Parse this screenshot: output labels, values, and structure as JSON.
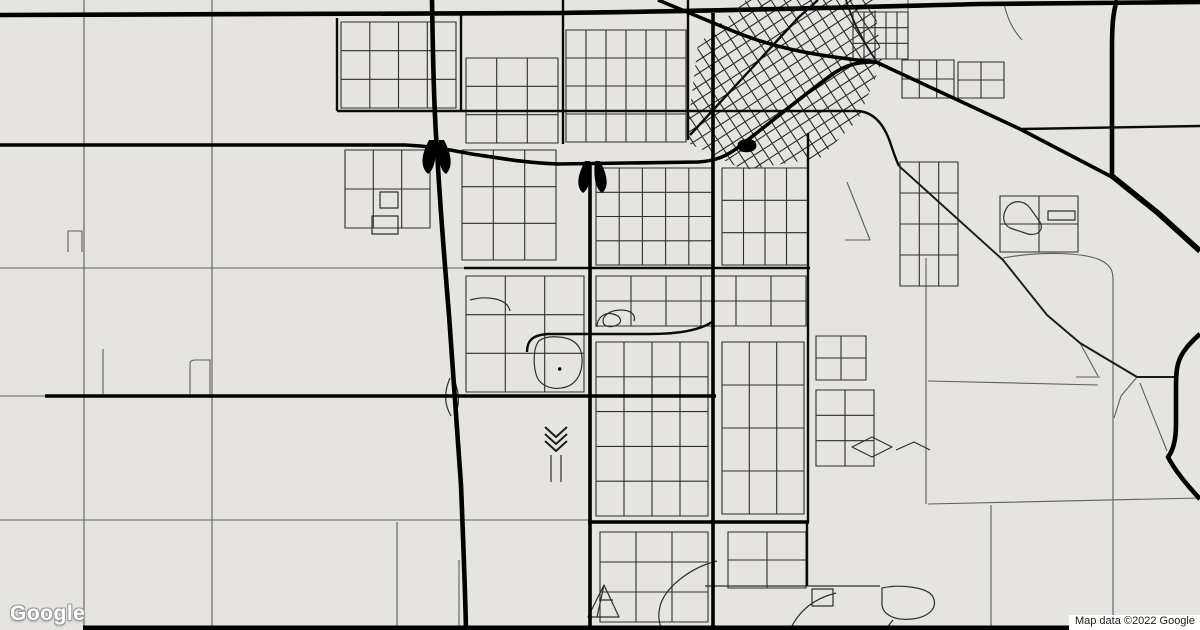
{
  "map": {
    "watermark": "Google",
    "attribution": "Map data ©2022 Google",
    "colors": {
      "land": "#e6e4e0",
      "road_black": "#000000",
      "street_gray": "#2e2e2e",
      "rural_gray": "#5e5e5e",
      "watermark_fill": "#ffffff",
      "watermark_outline": "#9b9b9b",
      "attribution_bg": "#ffffff",
      "attribution_text": "#1c1c1c"
    },
    "downtown": {
      "clip": "686,142 698,44 746,0 874,0 882,62 858,120 820,158 744,170",
      "transform": "rotate(-33 780 80)",
      "x0": 640,
      "x1": 960,
      "y0": -80,
      "y1": 230,
      "step": 11
    },
    "grids": [
      [
        341,
        22,
        115,
        86,
        4,
        3
      ],
      [
        466,
        58,
        92,
        85,
        3,
        3
      ],
      [
        566,
        30,
        120,
        112,
        6,
        4
      ],
      [
        853,
        12,
        55,
        47,
        5,
        3
      ],
      [
        902,
        60,
        52,
        38,
        3,
        2
      ],
      [
        958,
        62,
        46,
        36,
        2,
        2
      ],
      [
        345,
        150,
        85,
        78,
        3,
        2
      ],
      [
        462,
        150,
        94,
        110,
        3,
        3
      ],
      [
        596,
        168,
        116,
        97,
        5,
        4
      ],
      [
        722,
        168,
        86,
        97,
        4,
        3
      ],
      [
        900,
        162,
        58,
        124,
        3,
        4
      ],
      [
        466,
        276,
        118,
        116,
        3,
        3
      ],
      [
        596,
        276,
        210,
        50,
        6,
        2
      ],
      [
        596,
        342,
        112,
        174,
        4,
        5
      ],
      [
        722,
        342,
        82,
        172,
        3,
        4
      ],
      [
        600,
        532,
        108,
        90,
        3,
        3
      ],
      [
        728,
        532,
        78,
        56,
        2,
        2
      ],
      [
        816,
        390,
        58,
        76,
        2,
        3
      ],
      [
        1000,
        196,
        78,
        56,
        2,
        2
      ],
      [
        816,
        336,
        50,
        44,
        2,
        2
      ]
    ],
    "layers": [
      {
        "n": "rural-thin-roads",
        "s": "#5e5e5e",
        "w": 1.1,
        "p": [
          "M84,0 V626",
          "M212,0 V630",
          "M0,268 H464",
          "M0,520 H590",
          "M0,396 H46",
          "M926,258 V504",
          "M928,381 L1098,385",
          "M928,504 L1200,498",
          "M1113,278 V617",
          "M1003,258 C1042,251 1088,252 1104,262 C1111,267 1113,271 1113,280",
          "M397,522 V630",
          "M459,560 V630",
          "M991,505 V630",
          "M1080,343 L1098,376",
          "M1076,377 H1100",
          "M1140,383 L1167,451",
          "M1137,377 L1121,396 L1114,418",
          "M68,252 V231 H82 V252",
          "M103,349 V394",
          "M190,394 V364 Q190,360 195,360 H210 V394",
          "M847,182 L870,240 L845,240",
          "M1004,4 C1008,20 1013,30 1022,40",
          "M908,0 V58"
        ]
      },
      {
        "n": "local-street-shapes",
        "s": "#2e2e2e",
        "w": 1.2,
        "p": [
          "M537,344 C539,338 549,336 559,337 C573,338 581,345 582,357 C583,371 578,383 566,387 C553,391 539,386 536,374 C533,363 534,350 537,344 Z",
          "M597,327 C597,317 605,312 613,314 C621,316 623,322 617,325 C611,328 603,327 603,321 C603,315 611,310 621,310 C631,310 636,315 634,321",
          "M604,585 L619,617 L588,617 Z",
          "M604,585 L597,617",
          "M599,600 L613,600",
          "M717,561 C692,567 668,585 661,603 C657,615 659,625 663,630",
          "M790,630 C798,612 812,599 836,593",
          "M705,586 H838",
          "M812,589 H833 V606 H812 Z",
          "M838,586 H880",
          "M882,588 C900,584 928,587 933,597 C938,607 930,617 912,619 C896,621 883,615 882,605 Z",
          "M893,620 L885,630",
          "M1008,206 C1002,214 1002,224 1010,228 L1028,234 C1038,236 1044,230 1040,222 L1030,208 C1024,200 1014,200 1008,206 Z",
          "M1048,211 H1075 V220 H1048 Z",
          "M450,378 C444,392 444,404 451,416",
          "M453,378 C460,392 460,404 455,416",
          "M380,192 H398 V208 H380 Z",
          "M372,216 H398 V234 H372 Z",
          "M852,447 L872,437 L892,447 L872,457 Z",
          "M896,450 L914,442 L930,450",
          "M470,300 C488,295 508,299 510,311",
          "M551,455 V482",
          "M561,455 V482"
        ]
      },
      {
        "n": "collector-light-roads",
        "s": "#1a1a1a",
        "w": 1.9,
        "p": [
          "M899,166 L1003,260 L1047,315 L1080,343 L1137,377",
          "M1137,377 H1177",
          "M846,0 C852,20 862,40 877,62",
          "M545,427 L556,437 L567,427",
          "M545,434 L556,444 L567,434",
          "M545,441 L556,451 L567,441"
        ]
      },
      {
        "n": "collector-roads",
        "s": "#0a0a0a",
        "w": 2.4,
        "p": [
          "M337,18 V111",
          "M461,14 V111",
          "M563,0 V144",
          "M688,0 V140",
          "M337,111 H858 C872,112 883,122 890,142 C893,151 896,160 899,166",
          "M464,268 H810",
          "M527,352 C527,341 532,335 548,334 L650,334 C680,334 700,330 712,322",
          "M808,133 V522",
          "M807,522 V586",
          "M1022,129 L1200,126",
          "M818,0 L799,17 L690,135"
        ]
      },
      {
        "n": "arterial-roads",
        "s": "#000000",
        "w": 3.6,
        "p": [
          "M0,145 L405,145 C432,146 450,150 472,154 C505,159 528,163 558,164 L698,162 C716,161 727,156 740,146 C766,126 800,98 830,76 C847,63 861,62 876,62",
          "M713,13 V630",
          "M590,162 V630",
          "M45,396 H716",
          "M588,522 H809",
          "M658,0 L728,29 C768,46 806,55 876,62 L1020,129 L1112,177"
        ]
      },
      {
        "n": "highway-roads",
        "s": "#000000",
        "w": 4.6,
        "p": [
          "M0,15 L560,13 C720,11 860,7 980,4 L1200,2",
          "M432,0 C433,60 434,110 437,150 C440,205 444,255 449,315 C453,365 457,425 461,485 C463,535 465,585 466,630",
          "M1117,0 C1113,12 1112,26 1112,48 L1112,177",
          "M1200,334 C1191,342 1181,352 1178,364 C1176,372 1176,380 1176,392 L1176,424 C1176,442 1172,452 1168,457 C1174,469 1186,484 1200,499"
        ]
      },
      {
        "n": "highway-heavy-roads",
        "s": "#000000",
        "w": 5.6,
        "p": [
          "M1112,176 L1158,213 L1200,251"
        ]
      },
      {
        "n": "bottom-edge-road",
        "s": "#000000",
        "w": 5,
        "p": [
          "M83,628 H1078"
        ]
      },
      {
        "n": "interchange-fills",
        "f": "#000000",
        "p": [
          "M429,140 C421,155 420,167 428,174 C434,170 437,158 435,140 Z",
          "M439,140 C437,158 440,170 446,174 C453,167 452,155 444,140 Z",
          "M585,161 C577,176 576,187 583,193 C589,189 592,178 590,161 Z",
          "M595,161 C593,178 596,189 602,193 C609,187 608,176 600,161 Z",
          "M738,147 C736,142 741,139 748,139 C754,139 758,143 756,148 C753,153 744,153 740,151 C739,150 738,148 738,147 Z",
          "M558,369 a1.7,1.7 0 1,0 3.4,0 a1.7,1.7 0 1,0 -3.4,0 Z"
        ]
      }
    ]
  }
}
